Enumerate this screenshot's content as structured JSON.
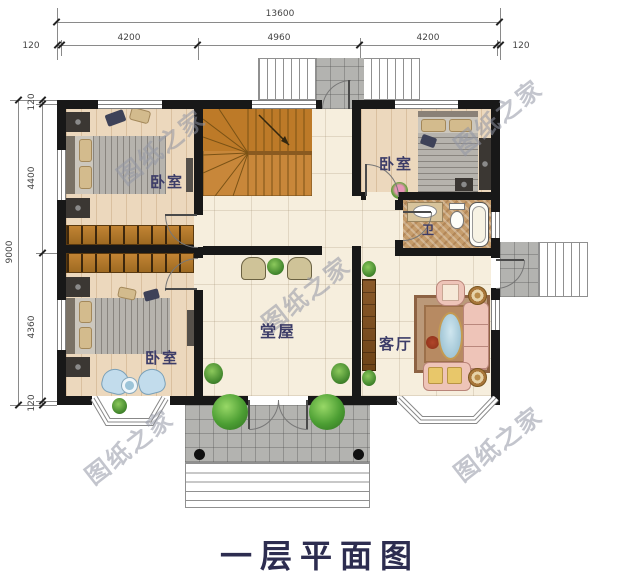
{
  "title": "一层平面图",
  "watermark": "图纸之家",
  "dimensions": {
    "top": {
      "total": "13600",
      "seg1": "4200",
      "seg2": "4960",
      "seg3": "4200",
      "margin_left": "120",
      "margin_right": "120"
    },
    "left": {
      "total": "9000",
      "seg1": "120",
      "seg2": "4400",
      "seg3": "4360",
      "seg4": "120"
    }
  },
  "rooms": {
    "bedroom_tl": "卧室",
    "bedroom_bl": "卧室",
    "bedroom_tr": "卧室",
    "hall": "堂屋",
    "living": "客厅",
    "bath": "卫"
  },
  "colors": {
    "wall": "#181818",
    "wood_floor": "#ecd8bd",
    "tile_floor": "#f6eedd",
    "stair_wood": "#c8873a",
    "porch_tile": "#b3b3b0",
    "label_text": "#3c3c68",
    "title_text": "#2d2d50",
    "watermark_text": "#9aa0ac"
  }
}
